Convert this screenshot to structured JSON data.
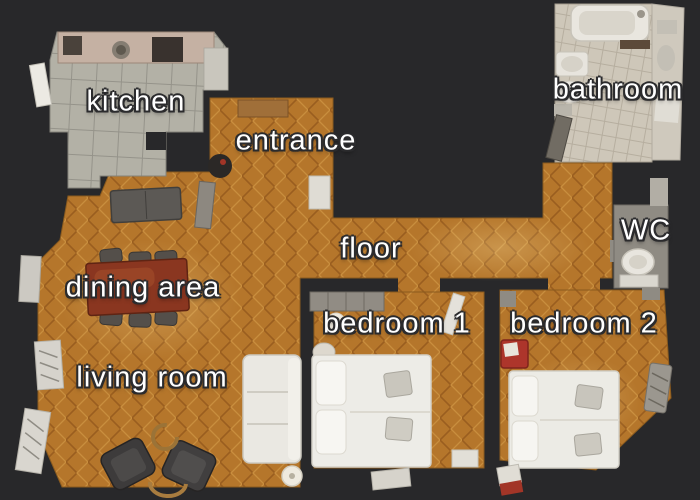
{
  "floorplan": {
    "view": "top-down apartment 3d-scan floor plan",
    "background_color": "#28282a",
    "label_text_color": "#ffffff",
    "rooms": [
      {
        "name": "kitchen",
        "label": "kitchen",
        "floor_type": "grey ceramic tile"
      },
      {
        "name": "entrance",
        "label": "entrance",
        "floor_type": "herringbone parquet"
      },
      {
        "name": "bathroom",
        "label": "bathroom",
        "floor_type": "beige tile"
      },
      {
        "name": "wc",
        "label": "WC",
        "floor_type": "grey stone"
      },
      {
        "name": "hallway",
        "label": "floor",
        "floor_type": "herringbone parquet"
      },
      {
        "name": "dining-area",
        "label": "dining area",
        "floor_type": "herringbone parquet"
      },
      {
        "name": "living-room",
        "label": "living room",
        "floor_type": "herringbone parquet"
      },
      {
        "name": "bedroom-1",
        "label": "bedroom 1",
        "floor_type": "herringbone parquet"
      },
      {
        "name": "bedroom-2",
        "label": "bedroom 2",
        "floor_type": "herringbone parquet"
      }
    ],
    "colors": {
      "parquet": "#b5762b",
      "kitchen_tile": "#b3b1a6",
      "bathroom_tile": "#cec7b9",
      "wc_floor": "#8f8b83",
      "white_furniture": "#eae8e2",
      "dark_furniture": "#3d3b3b",
      "dining_table_wood": "#8a3620",
      "accent_red": "#ad352b"
    },
    "furniture": [
      "kitchen counter",
      "stove",
      "kitchen sink",
      "coffee machine",
      "console table",
      "grey sofa",
      "dining table",
      "six dining chairs",
      "white sofa",
      "two dark armchairs",
      "rattan ring table",
      "floor lamp",
      "radiators",
      "wardrobe",
      "double bed 1",
      "double bed 2",
      "red chair",
      "bathtub",
      "washbasin",
      "bidet",
      "toilet"
    ]
  }
}
